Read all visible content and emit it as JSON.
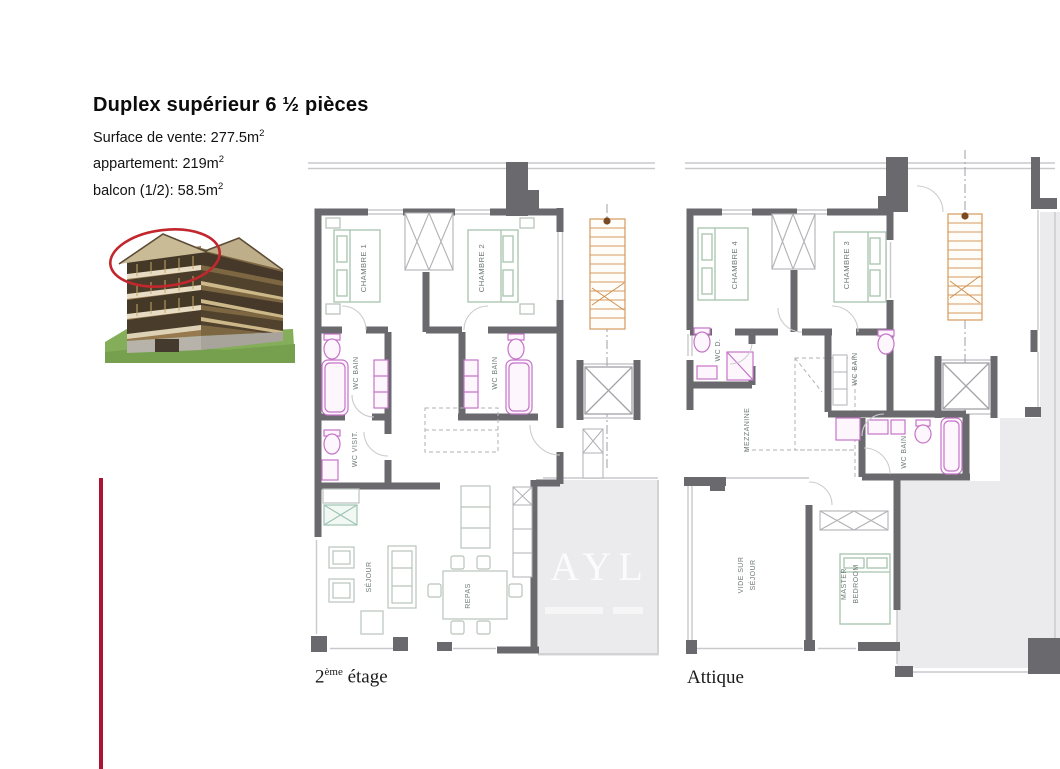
{
  "header": {
    "title": "Duplex supérieur 6 ½ pièces",
    "details": [
      {
        "label": "Surface de vente: 277.5m",
        "sup": "2"
      },
      {
        "label": "appartement: 219m",
        "sup": "2"
      },
      {
        "label": "balcon (1/2): 58.5m",
        "sup": "2"
      }
    ]
  },
  "watermark": "AYL",
  "plans": [
    {
      "label": {
        "base": "2",
        "sup": "ème",
        "rest": " étage"
      },
      "rooms": {
        "chambre1": "CHAMBRE 1",
        "chambre2": "CHAMBRE 2",
        "wcbain1": "WC BAIN",
        "wcbain2": "WC BAIN",
        "wcvisit": "WC VISIT.",
        "sejour": "SÉJOUR",
        "repas": "REPAS"
      }
    },
    {
      "label": {
        "base": "Attique",
        "sup": "",
        "rest": ""
      },
      "rooms": {
        "chambre4": "CHAMBRE 4",
        "chambre3": "CHAMBRE 3",
        "wcd": "WC D.",
        "wcbain_mid": "WC BAIN",
        "wcbain_low": "WC BAIN",
        "mezzanine": "MEZZANINE",
        "vide_line1": "VIDE SUR",
        "vide_line2": "SÉJOUR",
        "master_line1": "MASTER",
        "master_line2": "BEDROOM"
      }
    }
  ],
  "colors": {
    "wall": "#6a6a6e",
    "terrace": "#ebebed",
    "fixture_pink": "#c573c8",
    "bed_green": "#a6c4ac",
    "stairs_orange": "#d4995e",
    "accent_red_line": "#ad1431",
    "photo_circle_red": "#c2272d"
  }
}
